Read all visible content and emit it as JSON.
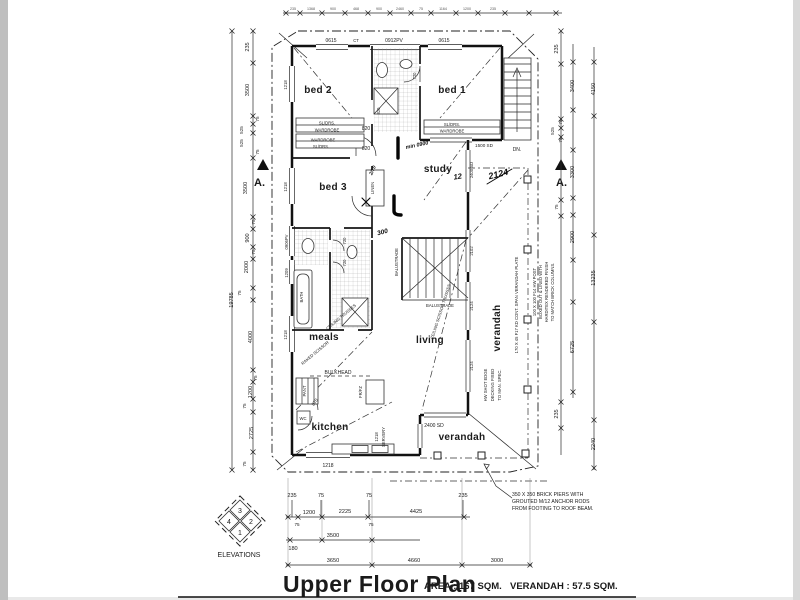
{
  "page": {
    "bg": "#ffffff",
    "edge": "#bfbfbf",
    "ink": "#1b1b1b"
  },
  "title": {
    "main": "Upper Floor Plan",
    "area": "AREA : 167 SQM.",
    "verandah": "VERANDAH : 57.5 SQM."
  },
  "rooms": {
    "bed1": "bed 1",
    "bed2": "bed 2",
    "bed3": "bed 3",
    "study": "study",
    "meals": "meals",
    "living": "living",
    "kitchen": "kitchen",
    "verandah_bottom": "verandah",
    "verandah_right": "verandah"
  },
  "labels": {
    "bath": "BATH",
    "wc": "WC",
    "pant": "PANT",
    "frfz": "FR/FZ",
    "servery": "SERVERY",
    "linen": "LINEN",
    "bulkhead": "BULKHEAD",
    "balustrade_v": "BALUSTRADE",
    "balustrade_h": "BALUSTRADE",
    "robe_top_1": "SL/DRS.",
    "robe_top_2": "WARDROBE",
    "robe_mid_1": "WARDROBE",
    "robe_mid_2": "SL/DRS.",
    "robe_bed1_1": "SL/DRS.",
    "robe_bed1_2": "WARDROBE",
    "dn": "DN.",
    "ct": "CT"
  },
  "trusses": {
    "living": "CEILING SCISSOR TRUSSES",
    "meals_a": "CEILING TRUSSES",
    "meals_b": "RAKED SCISSOR"
  },
  "openings": {
    "win_top_1": "0615",
    "win_top_2": "0912PV",
    "win_top_3": "0615",
    "win_left_1": "1218",
    "win_left_2": "1218",
    "win_left_3": "0906PV",
    "win_left_4": "1209",
    "win_left_5": "1218",
    "win_bottom": "1218",
    "servery_size": "1218",
    "door_820_1": "820",
    "door_820_2": "820",
    "door_820_3": "820",
    "door_720_1": "720",
    "door_720_2": "720",
    "door_720_3": "720",
    "door_870": "870",
    "sd_1500": "1500 SD",
    "sd_2400_study": "2400 SD",
    "sd_2400_living": "2400 SD",
    "pane_2102": "2102",
    "pane_2124_1": "2124",
    "pane_2124_2": "2124"
  },
  "handwriting": {
    "min0900": "min 0900",
    "big2124": "2124",
    "tick12": "12",
    "r300": "300",
    "frac270": "2/70"
  },
  "notes": {
    "piers1": "350 X 350 BRICK PIERS WITH",
    "piers2": "GROUTED M/12 ANCHOR RODS",
    "piers3": "FROM FOOTING TO ROOF BEAM.",
    "deck1": "HW SHOT EDGE",
    "deck2": "DECKING FIXED",
    "deck3": "TO MAN. SPEC.",
    "plate": "170 X 45  F17 KD CONT. SPAN VERANDAH PLATE",
    "post1": "100 X 100 F14 HW POST",
    "post2": "BOXED OUT & LINED WITH",
    "post3": "HARDITEX RENDERED FINISH",
    "post4": "TO MATCH BRICK COLUMNS."
  },
  "sections": {
    "left": "A.",
    "right": "A."
  },
  "elevations": {
    "caption": "ELEVATIONS",
    "n_top": "3",
    "n_left": "4",
    "n_right": "2",
    "n_bottom": "1"
  },
  "dims": {
    "left_total": "19785",
    "left": [
      "235",
      "3500",
      "75",
      "525",
      "525",
      "75",
      "3500",
      "75",
      "900",
      "75",
      "2000",
      "75",
      "4000",
      "75",
      "1200",
      "75",
      "2725",
      "75"
    ],
    "right_a": [
      "235",
      "525",
      "75",
      "75",
      "75",
      "235"
    ],
    "right_b": [
      "3400",
      "3300",
      "2900",
      "6725"
    ],
    "right_c": [
      "4150",
      "13235",
      "2240"
    ],
    "top": [
      "235",
      "1368",
      "900",
      "468",
      "900",
      "2460",
      "75",
      "1164",
      "1200",
      "235"
    ],
    "bot1": [
      "235",
      "75",
      "75",
      "235"
    ],
    "bot1v": [
      "1200",
      "2225",
      "4425"
    ],
    "bot2": [
      "75",
      "75"
    ],
    "bot2v": "3500",
    "b180": "180",
    "bot3": [
      "3650",
      "4660",
      "3000"
    ]
  }
}
